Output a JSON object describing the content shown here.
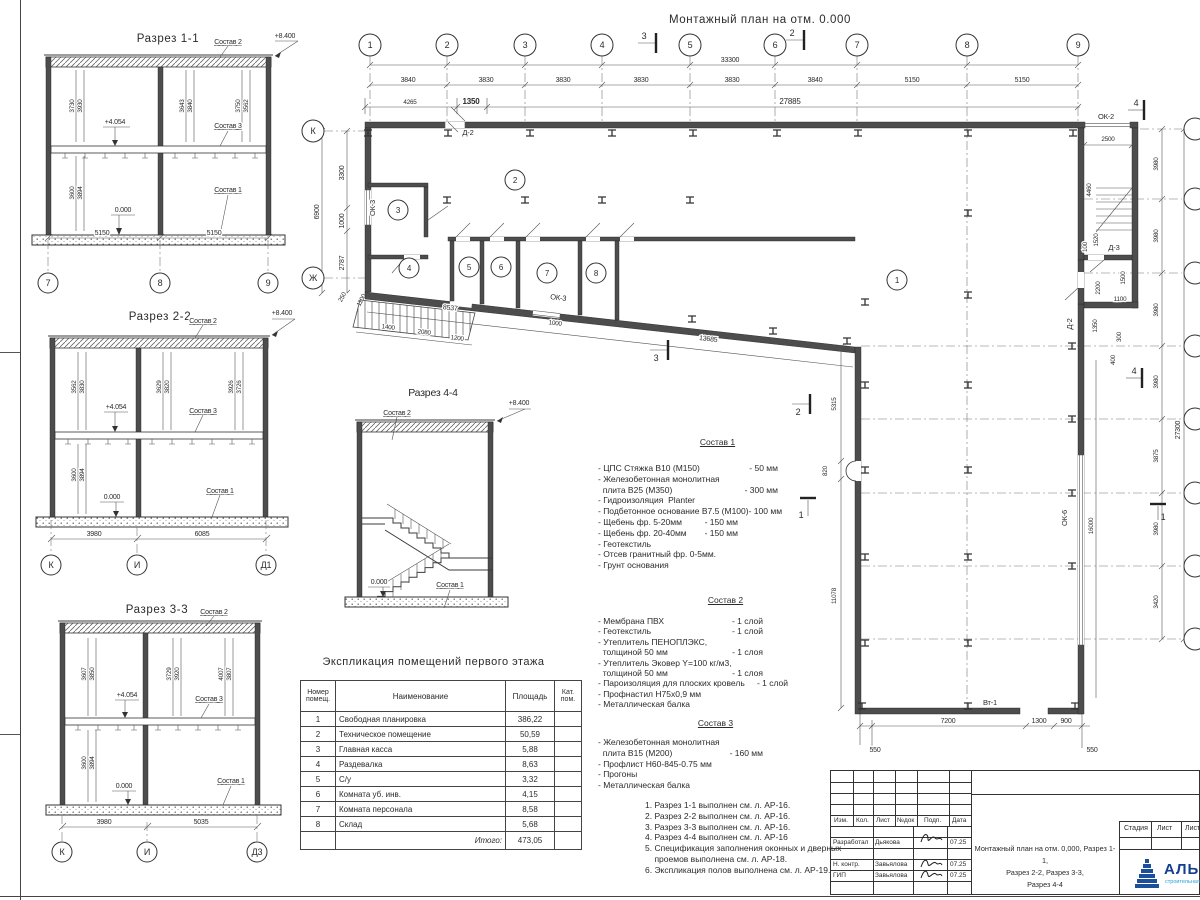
{
  "labels": {
    "sostav1": "Состав 1",
    "sostav2": "Состав 2",
    "sostav3": "Состав 3",
    "lv8": "+8.400",
    "lv4": "+4.054",
    "lv0": "0.000"
  },
  "sections": {
    "s11": {
      "title": "Разрез 1-1",
      "dl": [
        "3730",
        "3930"
      ],
      "dm": [
        "3643",
        "3840"
      ],
      "dr": [
        "3750",
        "3562"
      ],
      "dlow": [
        "3600",
        "3894"
      ],
      "db": [
        "5150",
        "5150"
      ],
      "ax": [
        "7",
        "8",
        "9"
      ]
    },
    "s22": {
      "title": "Разрез 2-2",
      "dl": [
        "3562",
        "3830"
      ],
      "dm": [
        "3629",
        "3820"
      ],
      "dr": [
        "3926",
        "3726"
      ],
      "dlow": [
        "3600",
        "3894"
      ],
      "db": [
        "3980",
        "6085"
      ],
      "ax": [
        "К",
        "И",
        "Д1"
      ]
    },
    "s33": {
      "title": "Разрез 3-3",
      "dl": [
        "3607",
        "3850"
      ],
      "dm": [
        "3729",
        "3920"
      ],
      "dr": [
        "4007",
        "3807"
      ],
      "dlow": [
        "3600",
        "3894"
      ],
      "db": [
        "3980",
        "5035"
      ],
      "ax": [
        "К",
        "И",
        "Д3"
      ]
    },
    "s44": {
      "title": "Разрез 4-4"
    }
  },
  "plan": {
    "title": "Монтажный план на отм. 0.000",
    "axes_top": [
      "1",
      "2",
      "3",
      "4",
      "5",
      "6",
      "7",
      "8",
      "9"
    ],
    "axes_left": [
      "К",
      "Ж"
    ],
    "dims_top": [
      "3840",
      "3830",
      "3830",
      "3830",
      "3830",
      "3840",
      "5150",
      "5150"
    ],
    "total_top": "33300",
    "dims_top2": [
      "4265",
      "1350",
      "27885"
    ],
    "dims_left": [
      "3300",
      "1000",
      "2787"
    ],
    "total_left": "6900",
    "dims_corner": [
      "250",
      "1100"
    ],
    "dims_right": [
      "3980",
      "3980",
      "3980",
      "3980",
      "3875",
      "3980",
      "3420"
    ],
    "total_right": "27300",
    "dims_stair": [
      "2500",
      "4460",
      "1520",
      "100",
      "1500",
      "2200",
      "1100",
      "1350",
      "300",
      "400"
    ],
    "dims_bottom": [
      "550",
      "7200",
      "1300",
      "900",
      "550"
    ],
    "dims_hall": [
      "5315",
      "820",
      "11078",
      "16000"
    ],
    "dim_wall": "13685",
    "dims_ramp": [
      "8537",
      "1400",
      "2080",
      "1200",
      "1000"
    ],
    "rooms": [
      "1",
      "2",
      "3",
      "4",
      "5",
      "6",
      "7",
      "8"
    ],
    "op": {
      "d2": "Д-2",
      "d3": "Д-3",
      "ok2": "ОК-2",
      "ok3": "ОК-3",
      "ok6": "ОК-6",
      "vt1": "Вт-1"
    },
    "markers": {
      "m1": "1",
      "m2": "2",
      "m3": "3",
      "m4": "4"
    }
  },
  "sostav1": {
    "items": [
      {
        "t": "- ЦПС Стяжка В10 (М150)",
        "v": "- 50 мм"
      },
      {
        "t": "- Железобетонная монолитная",
        "v": ""
      },
      {
        "t": "  плита В25 (М350)",
        "v": "- 300 мм"
      },
      {
        "t": "- Гидроизоляция  Planter",
        "v": ""
      },
      {
        "t": "- Подбетонное основание В7.5 (М100)",
        "v": "- 100 мм"
      },
      {
        "t": "- Щебень фр. 5-20мм",
        "v": "- 150 мм"
      },
      {
        "t": "- Щебень фр. 20-40мм",
        "v": "- 150 мм"
      },
      {
        "t": "- Геотекстиль",
        "v": ""
      },
      {
        "t": "- Отсев гранитный фр. 0-5мм.",
        "v": ""
      },
      {
        "t": "- Грунт основания",
        "v": ""
      }
    ]
  },
  "sostav2": {
    "items": [
      {
        "t": "- Мембрана ПВХ",
        "v": "- 1 слой"
      },
      {
        "t": "- Геотекстиль",
        "v": "- 1 слой"
      },
      {
        "t": "- Утеплитель ПЕНОПЛЭКС,",
        "v": ""
      },
      {
        "t": "  толщиной 50 мм",
        "v": "- 1 слоя"
      },
      {
        "t": "- Утеплитель Эковер Y=100 кг/м3,",
        "v": ""
      },
      {
        "t": "  толщиной 50 мм",
        "v": "- 1 слоя"
      },
      {
        "t": "- Пароизоляция для плоских кровель",
        "v": "- 1 слой"
      },
      {
        "t": "- Профнастил Н75х0,9 мм",
        "v": ""
      },
      {
        "t": "- Металлическая балка",
        "v": ""
      }
    ]
  },
  "sostav3": {
    "items": [
      {
        "t": "- Железобетонная монолитная",
        "v": ""
      },
      {
        "t": "  плита В15 (М200)",
        "v": "- 160 мм"
      },
      {
        "t": "- Профлист Н60-845-0.75 мм",
        "v": ""
      },
      {
        "t": "- Прогоны",
        "v": ""
      },
      {
        "t": "- Металлическая балка",
        "v": ""
      }
    ]
  },
  "notes": [
    "1. Разрез 1-1 выполнен см. л. АР-16.",
    "2. Разрез 2-2 выполнен см. л. АР-16.",
    "3. Разрез 3-3 выполнен см. л. АР-16.",
    "4. Разрез 4-4 выполнен см. л. АР-16",
    "5. Спецификация заполнения оконных и дверных",
    "    проемов выполнена см. л. АР-18.",
    "6. Экспликация полов выполнена см. л. АР-19."
  ],
  "table": {
    "title": "Экспликация помещений первого этажа",
    "headers": [
      "Номер помещ.",
      "Наименование",
      "Площадь",
      "Кат. пом."
    ],
    "rows": [
      [
        "1",
        "Свободная планировка",
        "386,22"
      ],
      [
        "2",
        "Техническое помещение",
        "50,59"
      ],
      [
        "3",
        "Главная касса",
        "5,88"
      ],
      [
        "4",
        "Раздевалка",
        "8,63"
      ],
      [
        "5",
        "С/у",
        "3,32"
      ],
      [
        "6",
        "Комната уб. инв.",
        "4,15"
      ],
      [
        "7",
        "Комната персонала",
        "8,58"
      ],
      [
        "8",
        "Склад",
        "5,68"
      ]
    ],
    "total_label": "Итого:",
    "total": "473,05"
  },
  "titleblock": {
    "cols": [
      "Изм.",
      "Кол.",
      "Лист",
      "№док",
      "Подп.",
      "Дата"
    ],
    "rows": [
      [
        "Разработал",
        "Дьякова",
        "07.25"
      ],
      [
        "Н. контр.",
        "Завьялова",
        "07.25"
      ],
      [
        "ГИП",
        "Завьялова",
        "07.25"
      ]
    ],
    "doc_title": [
      "Монтажный план на отм. 0,000, Разрез 1-1,",
      "Разрез 2-2, Разрез 3-3,",
      "Разрез 4-4"
    ],
    "stage_cols": [
      "Стадия",
      "Лист",
      "Листов"
    ],
    "logo": "АЛЬЯНС",
    "logo_sub": "строительная компания",
    "logo_blue": "#1a4f9c",
    "logo_light": "#2aa0d8"
  }
}
